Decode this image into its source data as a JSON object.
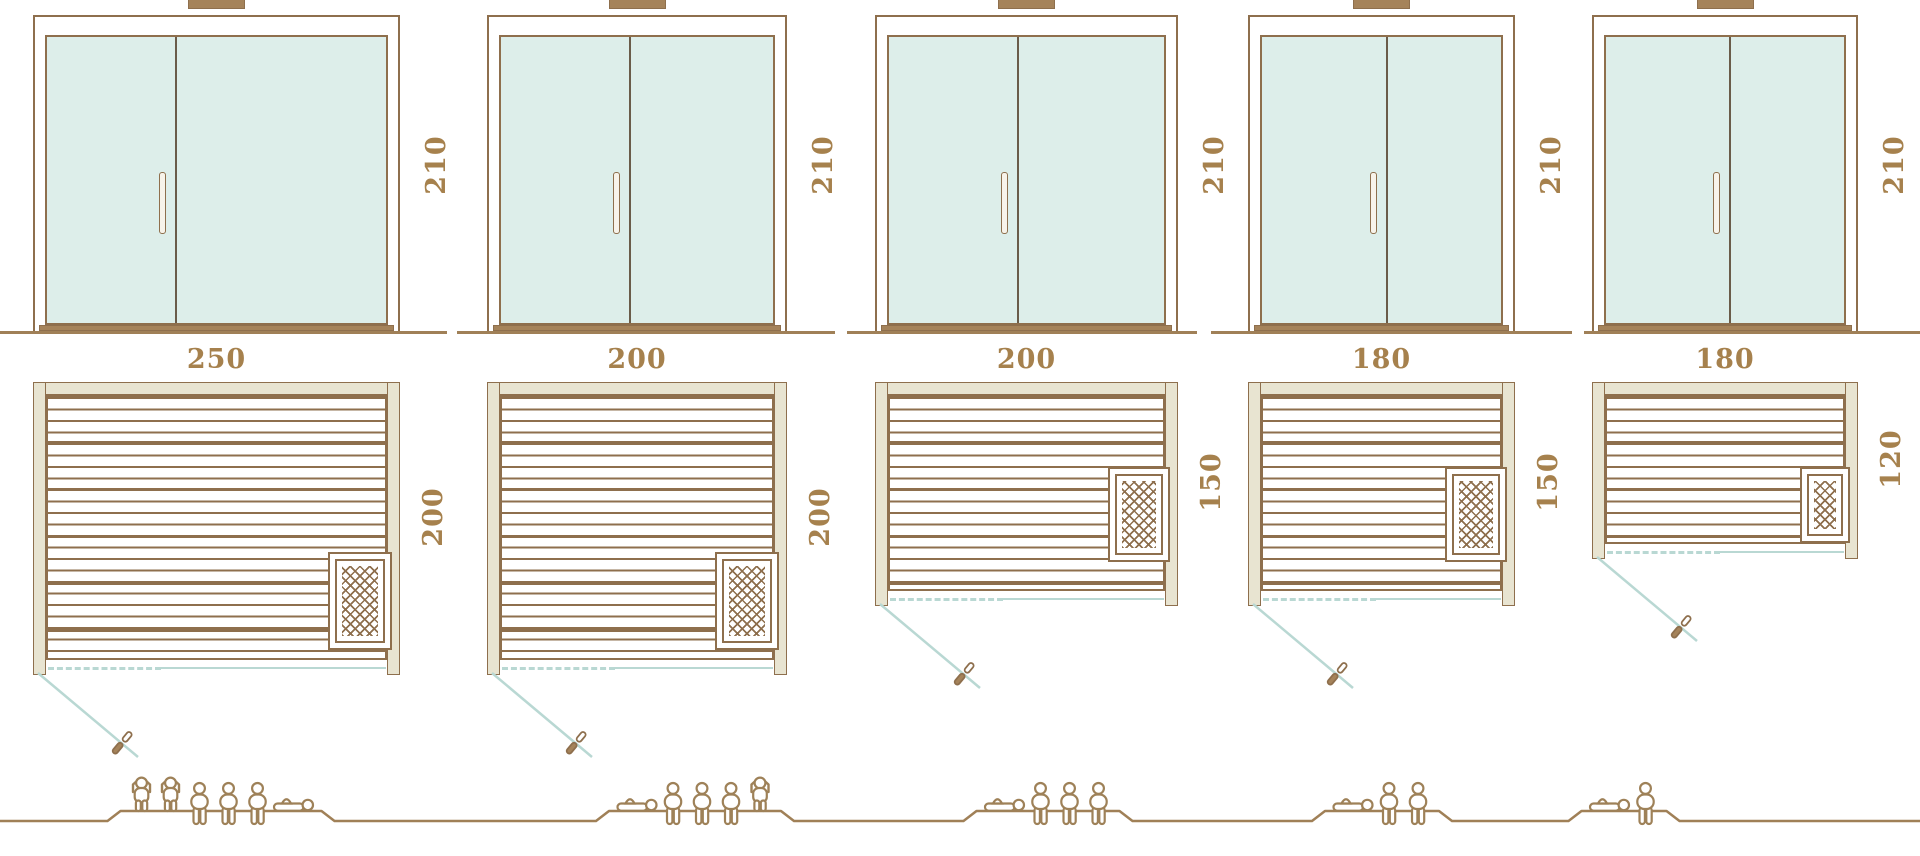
{
  "diagram": {
    "type": "sauna-size-comparison",
    "colors": {
      "outline_brown": "#8e6f4d",
      "fill_tan": "#a5835a",
      "wall_beige": "#e8e4d1",
      "glass_mint": "#ddeeea",
      "swing_blue": "#b9d8d3",
      "dimension_label_brown": "#a6814d",
      "ground_brown": "#a08057",
      "figure_outline": "#9e8158"
    },
    "units": [
      {
        "name": "sauna-250x200",
        "door": {
          "height_cm": 210,
          "leaves": 2,
          "handle": "vertical-bar"
        },
        "plan": {
          "width_cm": 250,
          "depth_cm": 200,
          "heater_position": "bottom-right"
        },
        "capacity": {
          "persons": 6,
          "figures": [
            "standing",
            "standing",
            "sitting",
            "sitting",
            "sitting",
            "lying"
          ]
        }
      },
      {
        "name": "sauna-200x200",
        "door": {
          "height_cm": 210,
          "leaves": 2,
          "handle": "vertical-bar"
        },
        "plan": {
          "width_cm": 200,
          "depth_cm": 200,
          "heater_position": "bottom-right"
        },
        "capacity": {
          "persons": 5,
          "figures": [
            "lying",
            "sitting",
            "sitting",
            "sitting",
            "standing"
          ]
        }
      },
      {
        "name": "sauna-200x150",
        "door": {
          "height_cm": 210,
          "leaves": 2,
          "handle": "vertical-bar"
        },
        "plan": {
          "width_cm": 200,
          "depth_cm": 150,
          "heater_position": "middle-right"
        },
        "capacity": {
          "persons": 4,
          "figures": [
            "lying",
            "sitting",
            "sitting",
            "sitting"
          ]
        }
      },
      {
        "name": "sauna-180x150",
        "door": {
          "height_cm": 210,
          "leaves": 2,
          "handle": "vertical-bar"
        },
        "plan": {
          "width_cm": 180,
          "depth_cm": 150,
          "heater_position": "middle-right"
        },
        "capacity": {
          "persons": 3,
          "figures": [
            "lying",
            "sitting",
            "sitting"
          ]
        }
      },
      {
        "name": "sauna-180x120",
        "door": {
          "height_cm": 210,
          "leaves": 2,
          "handle": "vertical-bar"
        },
        "plan": {
          "width_cm": 180,
          "depth_cm": 120,
          "heater_position": "middle-right"
        },
        "capacity": {
          "persons": 2,
          "figures": [
            "lying",
            "sitting"
          ]
        }
      }
    ]
  }
}
